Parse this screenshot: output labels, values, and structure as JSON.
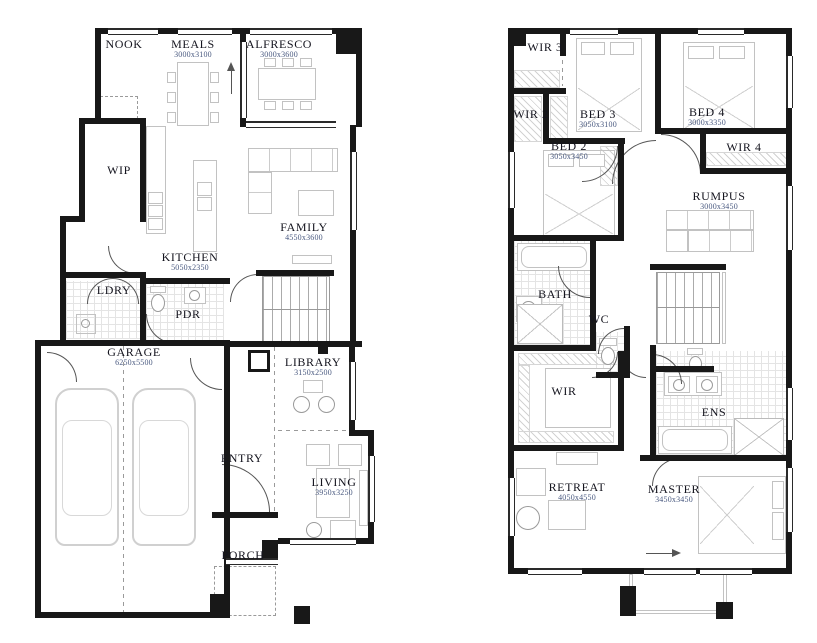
{
  "title": "Two storey house floor plan",
  "colors": {
    "wall": "#181818",
    "label": "#14141e",
    "dimension": "#4a5a80",
    "furniture_outline": "#c2c2c2"
  },
  "plans": {
    "ground": {
      "rooms": [
        {
          "name": "NOOK",
          "dim": ""
        },
        {
          "name": "MEALS",
          "dim": "3000x3100"
        },
        {
          "name": "ALFRESCO",
          "dim": "3000x3600"
        },
        {
          "name": "WIP",
          "dim": ""
        },
        {
          "name": "KITCHEN",
          "dim": "5050x2350"
        },
        {
          "name": "FAMILY",
          "dim": "4550x3600"
        },
        {
          "name": "LDRY",
          "dim": ""
        },
        {
          "name": "PDR",
          "dim": ""
        },
        {
          "name": "GARAGE",
          "dim": "6250x5500"
        },
        {
          "name": "LIBRARY",
          "dim": "3150x2500"
        },
        {
          "name": "ENTRY",
          "dim": ""
        },
        {
          "name": "LIVING",
          "dim": "3950x3250"
        },
        {
          "name": "PORCH",
          "dim": ""
        }
      ]
    },
    "upper": {
      "rooms": [
        {
          "name": "WIR 3",
          "dim": ""
        },
        {
          "name": "BED 3",
          "dim": "3050x3100"
        },
        {
          "name": "BED 4",
          "dim": "3000x3350"
        },
        {
          "name": "WIR 2",
          "dim": ""
        },
        {
          "name": "BED 2",
          "dim": "3050x3450"
        },
        {
          "name": "WIR 4",
          "dim": ""
        },
        {
          "name": "RUMPUS",
          "dim": "3000x3450"
        },
        {
          "name": "BATH",
          "dim": ""
        },
        {
          "name": "WC",
          "dim": ""
        },
        {
          "name": "WIR",
          "dim": ""
        },
        {
          "name": "ENS",
          "dim": ""
        },
        {
          "name": "RETREAT",
          "dim": "4050x4550"
        },
        {
          "name": "MASTER",
          "dim": "3450x3450"
        }
      ]
    }
  }
}
